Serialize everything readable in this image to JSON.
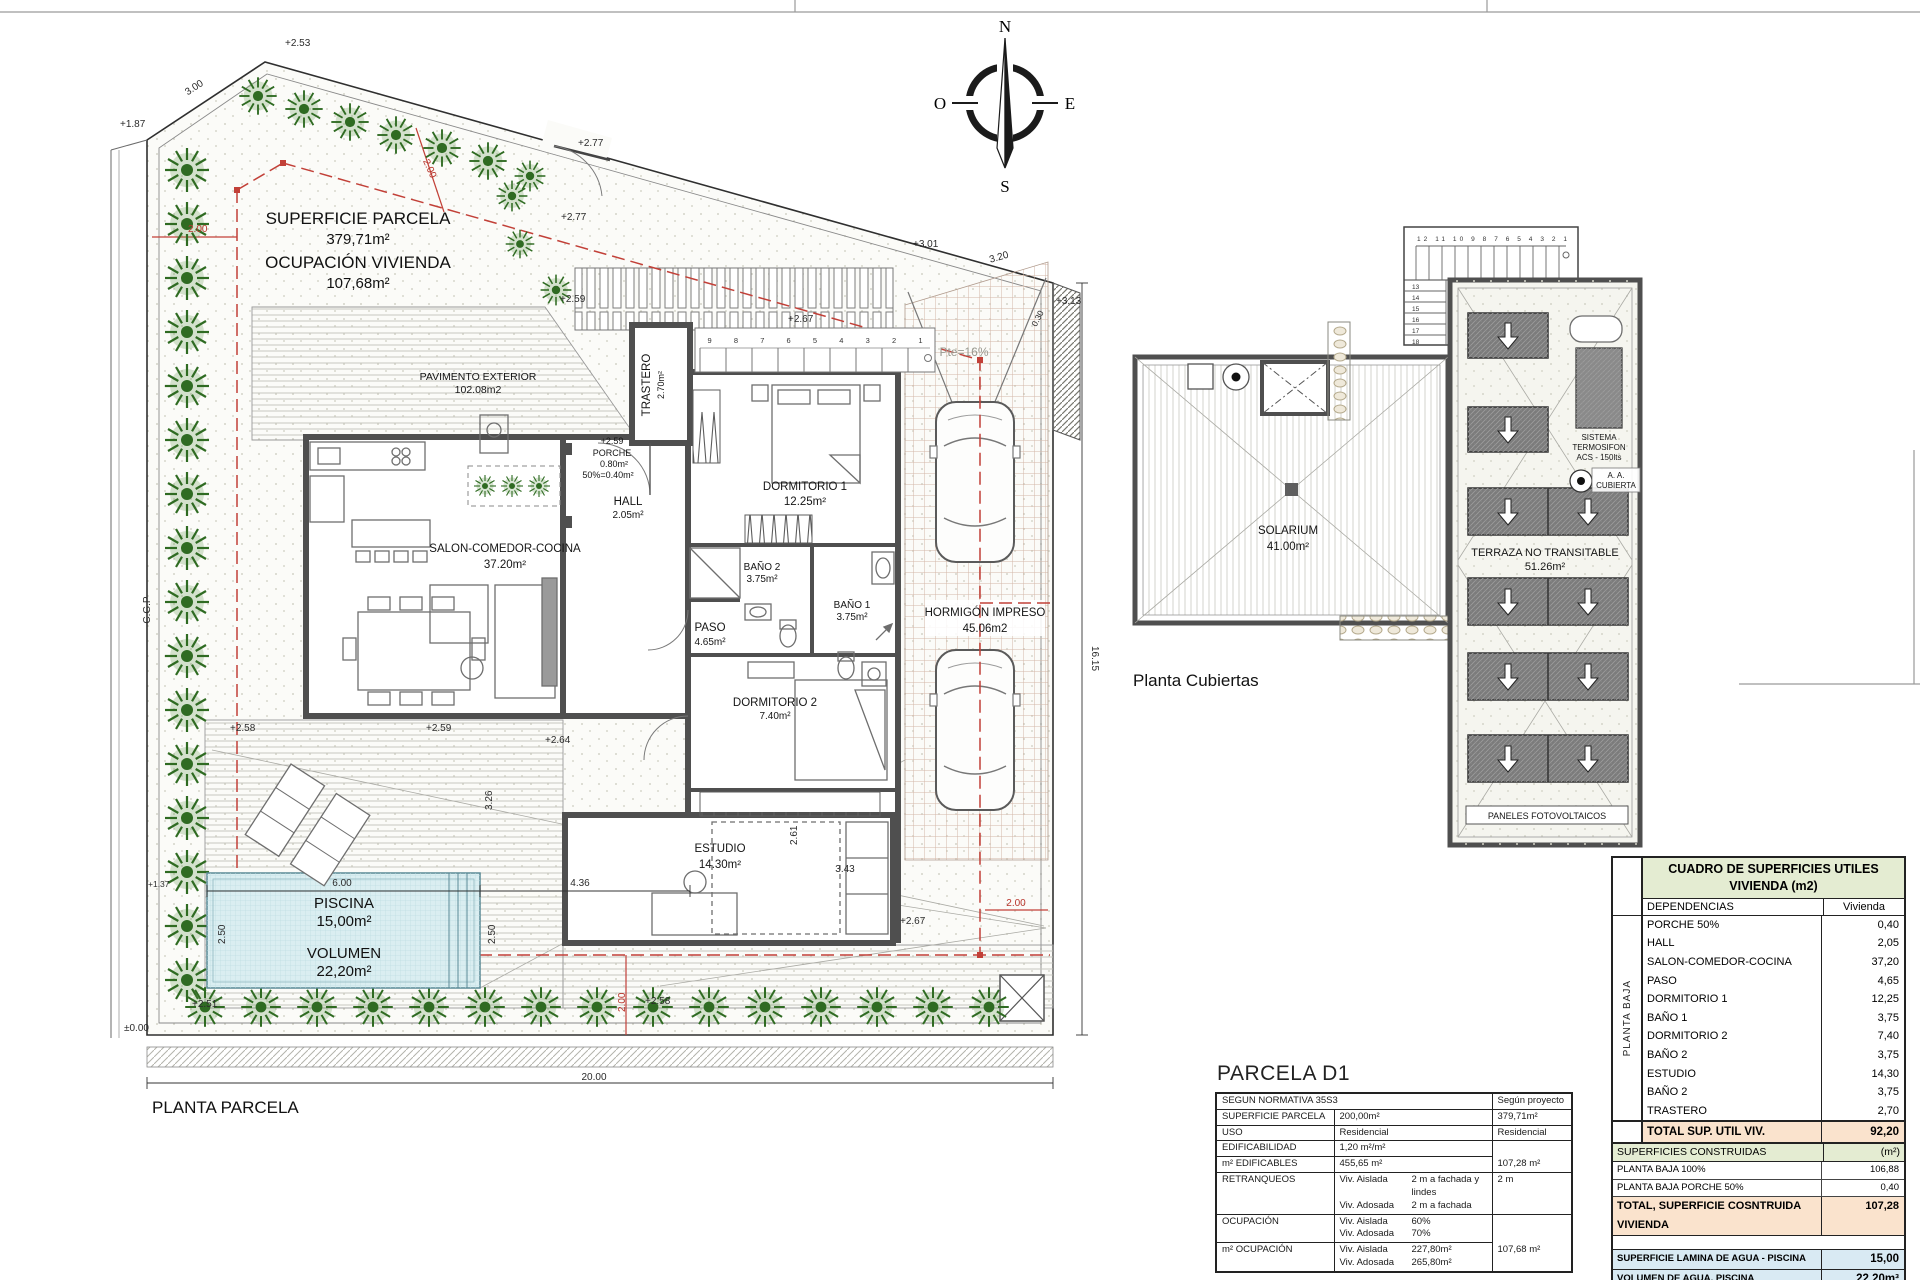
{
  "sheet": {
    "plan_title": "PLANTA PARCELA",
    "roof_title": "Planta Cubiertas"
  },
  "compass": {
    "n": "N",
    "s": "S",
    "e": "E",
    "o": "O"
  },
  "site": {
    "superficie_parcela_label": "SUPERFICIE PARCELA",
    "superficie_parcela_value": "379,71m²",
    "ocupacion_label": "OCUPACIÓN VIVIENDA",
    "ocupacion_value": "107,68m²",
    "pavimento_label": "PAVIMENTO EXTERIOR",
    "pavimento_value": "102.08m2",
    "hormigon_label": "HORMIGÓN IMPRESO",
    "hormigon_value": "45.06m2",
    "pendiente": "Pte=16%",
    "cgp": "C.G.P",
    "stair_numbers": "9  8  7  6  5  4  3  2  1"
  },
  "rooms": {
    "trastero": {
      "name": "TRASTERO",
      "area": "2.70m²"
    },
    "porche": {
      "elev": "+2.59",
      "name": "PORCHE",
      "area": "0.80m²",
      "pct": "50%=0.40m²"
    },
    "hall": {
      "name": "HALL",
      "area": "2.05m²"
    },
    "salon": {
      "name": "SALON-COMEDOR-COCINA",
      "area": "37.20m²"
    },
    "dorm1": {
      "name": "DORMITORIO 1",
      "area": "12.25m²"
    },
    "bano2": {
      "name": "BAÑO 2",
      "area": "3.75m²"
    },
    "bano1": {
      "name": "BAÑO 1",
      "area": "3.75m²"
    },
    "paso": {
      "name": "PASO",
      "area": "4.65m²"
    },
    "dorm2": {
      "name": "DORMITORIO 2",
      "area": "7.40m²"
    },
    "estudio": {
      "name": "ESTUDIO",
      "area": "14.30m²"
    }
  },
  "pool": {
    "name": "PISCINA",
    "area": "15,00m²",
    "vol_label": "VOLUMEN",
    "vol_value": "22,20m²"
  },
  "dims": {
    "d_253": "+2.53",
    "d_300": "3.00",
    "d_187": "+1.87",
    "d_200a": "2.00",
    "d_200b": "2.00",
    "d_200c": "2.00",
    "d_200d": "2.00",
    "d_277a": "+2.77",
    "d_277b": "+2.77",
    "d_259a": "+2.59",
    "d_259b": "+2.59",
    "d_258a": "+2.58",
    "d_258b": "+2.58",
    "d_264": "+2.64",
    "d_251": "+2.51",
    "d_267a": "+2.67",
    "d_267b": "+2.67",
    "d_000": "±0.00",
    "d_137": "+1.37",
    "d_1615": "16.15",
    "d_2000": "20.00",
    "d_320": "3.20",
    "d_301": "+3.01",
    "d_313": "+3.13",
    "d_030": "0.30",
    "d_600": "6.00",
    "d_250a": "2.50",
    "d_250b": "2.50",
    "d_436": "4.36",
    "d_326": "3.26",
    "d_261": "2.61",
    "d_343": "3.43"
  },
  "roof": {
    "solarium_name": "SOLARIUM",
    "solarium_area": "41.00m²",
    "terraza_name": "TERRAZA NO TRANSITABLE",
    "terraza_area": "51.26m²",
    "sistema_line1": "SISTEMA",
    "sistema_line2": "TERMOSIFON",
    "sistema_line3": "ACS - 150lts",
    "aa_line1": "A. A.",
    "aa_line2": "CUBIERTA",
    "paneles": "PANELES FOTOVOLTAICOS",
    "stair_top": "12 11 10 9 8 7 6 5 4 3 2 1",
    "stair_side": [
      "13",
      "14",
      "15",
      "16",
      "17",
      "18"
    ]
  },
  "parcela_table": {
    "title": "PARCELA D1",
    "header_left": "SEGUN NORMATIVA 35S3",
    "header_right": "Según proyecto",
    "rows": [
      {
        "label": "SUPERFICIE PARCELA",
        "norm": "200,00m²",
        "proj": "379,71m²"
      },
      {
        "label": "USO",
        "norm": "Residencial",
        "proj": "Residencial"
      },
      {
        "label": "EDIFICABILIDAD",
        "norm": "1,20 m²/m²",
        "proj": ""
      },
      {
        "label": "m² EDIFICABLES",
        "norm": "455,65 m²",
        "proj": "107,28 m²"
      },
      {
        "label": "RETRANQUEOS",
        "proj": "2 m",
        "lines": [
          {
            "k": "Viv. Aislada",
            "v": "2 m a fachada y lindes"
          },
          {
            "k": "Viv. Adosada",
            "v": "2 m a fachada"
          }
        ]
      },
      {
        "label": "OCUPACIÓN",
        "proj": "",
        "lines": [
          {
            "k": "Viv. Aislada",
            "v": "60%"
          },
          {
            "k": "Viv. Adosada",
            "v": "70%"
          }
        ]
      },
      {
        "label": "m² OCUPACIÓN",
        "proj": "107,68 m²",
        "lines": [
          {
            "k": "Viv. Aislada",
            "v": "227,80m²"
          },
          {
            "k": "Viv. Adosada",
            "v": "265,80m²"
          }
        ]
      }
    ]
  },
  "cuadro_table": {
    "title_line1": "CUADRO DE SUPERFICIES UTILES",
    "title_line2": "VIVIENDA (m2)",
    "col_dep": "DEPENDENCIAS",
    "col_viv": "Vivienda",
    "side_label": "PLANTA BAJA",
    "rows": [
      {
        "label": "PORCHE 50%",
        "value": "0,40"
      },
      {
        "label": "HALL",
        "value": "2,05"
      },
      {
        "label": "SALON-COMEDOR-COCINA",
        "value": "37,20"
      },
      {
        "label": "PASO",
        "value": "4,65"
      },
      {
        "label": "DORMITORIO 1",
        "value": "12,25"
      },
      {
        "label": "BAÑO 1",
        "value": "3,75"
      },
      {
        "label": "DORMITORIO 2",
        "value": "7,40"
      },
      {
        "label": "BAÑO 2",
        "value": "3,75"
      },
      {
        "label": "ESTUDIO",
        "value": "14,30"
      },
      {
        "label": "BAÑO 2",
        "value": "3,75"
      },
      {
        "label": "TRASTERO",
        "value": "2,70"
      }
    ],
    "total_label": "TOTAL SUP. UTIL VIV.",
    "total_value": "92,20",
    "constructed_header": "SUPERFICIES CONSTRUIDAS",
    "constructed_unit": "(m²)",
    "constructed_rows": [
      {
        "label": "PLANTA BAJA 100%",
        "value": "106,88"
      },
      {
        "label": "PLANTA BAJA PORCHE 50%",
        "value": "0,40"
      }
    ],
    "constructed_total_label": "TOTAL, SUPERFICIE COSNTRUIDA VIVIENDA",
    "constructed_total_value": "107,28",
    "pool_rows": [
      {
        "label": "SUPERFICIE LAMINA DE AGUA - PISCINA",
        "value": "15,00"
      },
      {
        "label": "VOLUMEN DE AGUA, PISCINA",
        "value": "22,20m³"
      }
    ]
  },
  "colors": {
    "red": "#c24038",
    "tree": "#2f6b22",
    "pool": "#daeef1",
    "table_green": "#e4ecd2",
    "table_peach": "#fae3cd",
    "table_blue": "#d9eaf3"
  }
}
